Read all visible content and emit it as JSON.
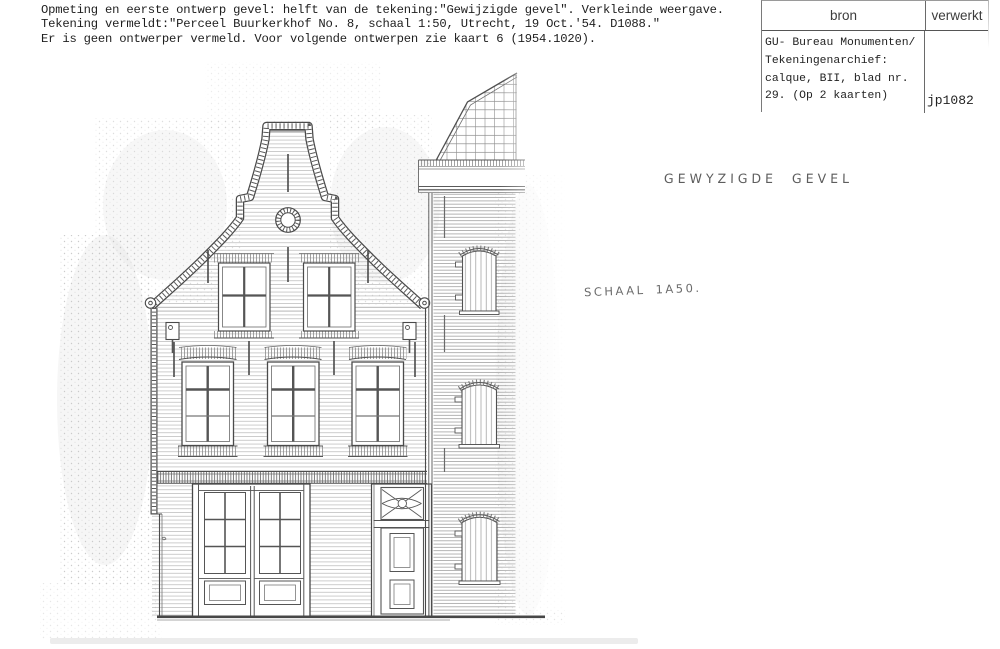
{
  "page": {
    "description_lines": [
      "Opmeting en eerste ontwerp gevel: helft van de tekening:\"Gewijzigde gevel\". Verkleinde weergave.",
      "Tekening vermeldt:\"Perceel Buurkerkhof No. 8, schaal 1:50, Utrecht, 19 Oct.'54. D1088.\"",
      "Er is geen ontwerper vermeld. Voor volgende ontwerpen zie kaart 6 (1954.1020)."
    ],
    "register_table": {
      "headers": {
        "source": "bron",
        "processed": "verwerkt"
      },
      "source_lines": [
        "GU- Bureau Monumenten/",
        "Tekeningenarchief:",
        "calque, BII, blad nr.",
        "29. (Op 2 kaarten)"
      ],
      "processed_value": "jp1082"
    },
    "annotations": {
      "drawing_title": "GEWYZIGDE GEVEL",
      "drawing_scale": "SCHAAL 1A50."
    },
    "colors": {
      "ink": "#4a4a4a",
      "paper": "#ffffff",
      "scan_shadow": "#ececec"
    }
  }
}
